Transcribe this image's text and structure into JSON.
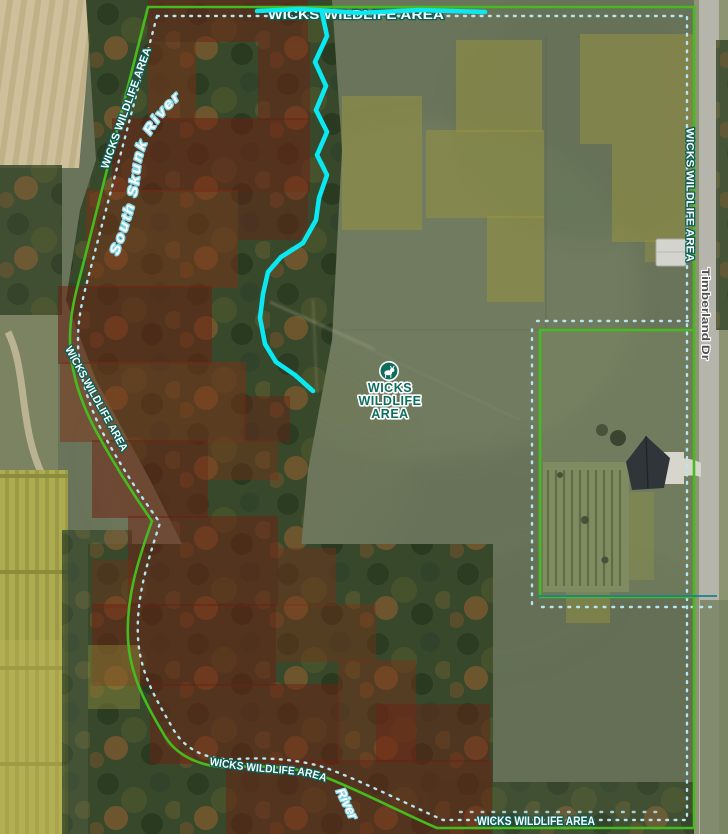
{
  "map": {
    "type": "aerial-imagery-with-overlays",
    "labels": {
      "center": [
        "WICKS",
        "WILDLIFE",
        "AREA"
      ],
      "top_edge": "WICKS WILDLIFE AREA",
      "left_upper": "WICKS WILDLIFE AREA",
      "left_lower": "WICKS WILDLIFE AREA",
      "right_edge": "WICKS WILDLIFE AREA",
      "bottom_curve": "WICKS WILDLIFE AREA",
      "bottom_right": "WICKS WILDLIFE AREA",
      "river": "South Skunk River",
      "river_repeat": "River",
      "road": "Timberland Dr"
    },
    "icons": [
      {
        "name": "deer-icon",
        "meaning": "wildlife area marker"
      }
    ],
    "colors": {
      "boundary_green": "#46bb20",
      "boundary_dots_cyan": "#b5e6f2",
      "trail_cyan": "#0ae8f2",
      "inholding_teal": "#20808e",
      "label_fill": "#ffffff",
      "label_halo_teal": "#0c6056",
      "center_label_teal": "#0e6e5c",
      "river_label_halo": "#86d7e6",
      "road_label_gray": "#4f4f4f",
      "overlay_red": "#6e2012",
      "overlay_olive": "#9a963e"
    }
  }
}
